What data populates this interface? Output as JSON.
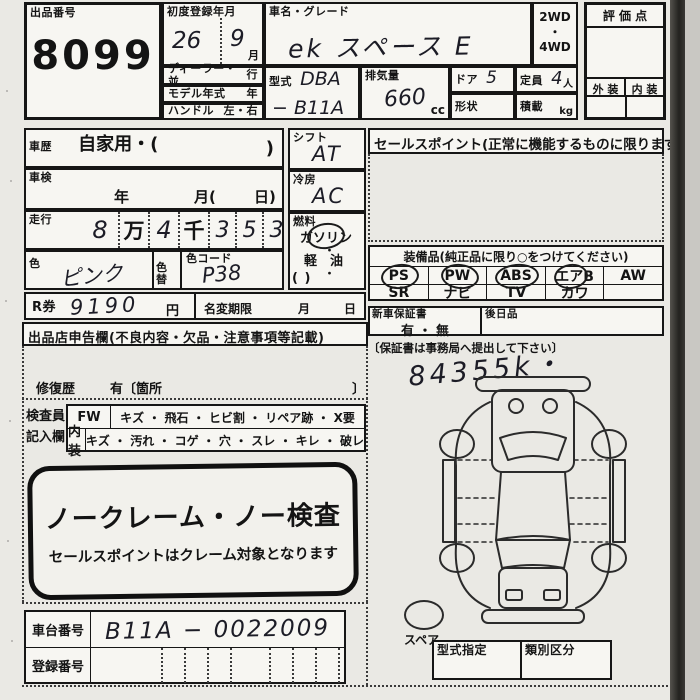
{
  "header": {
    "exhibit_no_label": "出品番号",
    "exhibit_no": "8099",
    "first_reg_label": "初度登録年月",
    "first_reg_year": "26",
    "first_reg_month": "9",
    "month_unit": "月",
    "dealer_parallel_label": "ディーラー・並",
    "dealer_parallel_right": "行",
    "model_year_label": "モデル年式",
    "model_year_unit": "年",
    "handle_label": "ハンドル",
    "handle_value": "左・右",
    "car_name_label": "車名・グレード",
    "car_name": "ek スペース E",
    "drive_top": "2WD",
    "drive_dot": "・",
    "drive_bottom": "4WD",
    "model_code_label": "型式",
    "model_code_line1": "DBA",
    "model_code_line2": "− B11A",
    "displacement_label": "排気量",
    "displacement_value": "660",
    "displacement_unit": "cc",
    "doors_label": "ドア",
    "doors_value": "5",
    "shape_label": "形状",
    "capacity_label": "定員",
    "capacity_value": "4",
    "capacity_unit": "人",
    "load_label": "積載",
    "load_unit": "kg",
    "score_label": "評 価 点",
    "exterior_label": "外 装",
    "interior_label": "内 装"
  },
  "left": {
    "history_label": "車歴",
    "history_value": "自家用・(",
    "history_close": ")",
    "inspection_label": "車検",
    "inspection_year": "年",
    "inspection_month": "月(",
    "inspection_day": "日)",
    "mileage_label": "走行",
    "mileage_cells": [
      "8",
      "万",
      "4",
      "千",
      "3",
      "5",
      "3"
    ],
    "mileage_unit": "km",
    "color_label": "色",
    "color_value": "ピンク",
    "color_change_label": "色替",
    "color_code_label": "色コード",
    "color_code_value": "P38",
    "recycle_label": "R券",
    "recycle_value": "9190",
    "recycle_unit": "円",
    "name_change_label": "名変期限",
    "name_change_month": "月",
    "name_change_day": "日",
    "declaration_header": "出品店申告欄(不良内容・欠品・注意事項等記載)",
    "repair_label": "修復歴",
    "repair_value": "有〔箇所",
    "repair_close": "〕",
    "inspector_line1": "検査員",
    "inspector_line2": "記入欄",
    "fw_label": "FW",
    "fw_items": "キズ ・ 飛石 ・ ヒビ割 ・ リペア跡 ・ X要",
    "int_label": "内装",
    "int_items": "キズ ・ 汚れ ・ コゲ ・ 穴 ・ スレ ・ キレ ・ 破レ",
    "stamp_title": "ノークレーム・ノー検査",
    "stamp_subtitle": "セールスポイントはクレーム対象となります",
    "chassis_label": "車台番号",
    "chassis_value": "B11A − 0022009",
    "registration_label": "登録番号"
  },
  "middle": {
    "shift_label": "シフト",
    "shift_value": "AT",
    "ac_label": "冷房",
    "ac_value": "AC",
    "fuel_label": "燃料",
    "fuel_gasoline": "ガソリン",
    "fuel_dot1": "・",
    "fuel_diesel": "軽　油",
    "fuel_dot2": "・",
    "fuel_other": "(            )"
  },
  "right": {
    "sales_point_header": "セールスポイント(正常に機能するものに限ります)",
    "equipment_header": "装備品(純正品に限り○をつけてください)",
    "equipment_row1": [
      {
        "label": "PS",
        "circled": true
      },
      {
        "label": "PW",
        "circled": true
      },
      {
        "label": "ABS",
        "circled": true
      },
      {
        "label": "エアB",
        "circled": true
      },
      {
        "label": "AW",
        "circled": false
      }
    ],
    "equipment_row2": [
      {
        "label": "SR"
      },
      {
        "label": "ナビ"
      },
      {
        "label": "TV"
      },
      {
        "label": "カワ"
      },
      {
        "label": ""
      }
    ],
    "warranty_label": "新車保証書",
    "warranty_value": "有 ・ 無",
    "later_item_label": "後日品",
    "warranty_note": "〔保証書は事務局へ提出して下さい〕",
    "handwritten_note": "84355k・",
    "spare_label": "スペア",
    "type_designation_label": "型式指定",
    "class_division_label": "類別区分"
  }
}
